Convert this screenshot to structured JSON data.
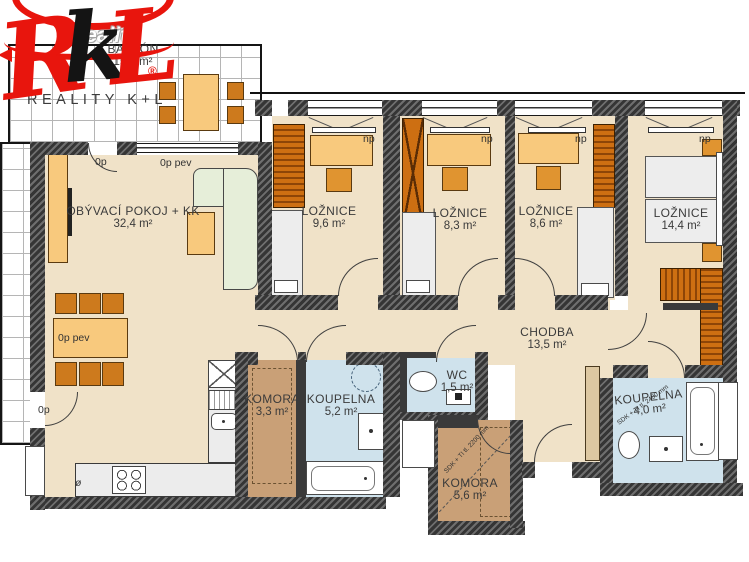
{
  "watermark": {
    "text": "Reality"
  },
  "logo": {
    "letter_r": "R",
    "letter_k": "k",
    "letter_l": "L",
    "registered": "®",
    "company": "REALITY K+L"
  },
  "rooms": {
    "balkon": {
      "name": "BALKÓN",
      "area": "15,5 m²"
    },
    "obyvaci": {
      "name": "OBÝVACÍ POKOJ + KK",
      "area": "32,4 m²"
    },
    "loznice1": {
      "name": "LOŽNICE",
      "area": "9,6 m²"
    },
    "loznice2": {
      "name": "LOŽNICE",
      "area": "8,3 m²"
    },
    "loznice3": {
      "name": "LOŽNICE",
      "area": "8,6 m²"
    },
    "loznice4": {
      "name": "LOŽNICE",
      "area": "14,4 m²"
    },
    "chodba": {
      "name": "CHODBA",
      "area": "13,5 m²"
    },
    "komora1": {
      "name": "KOMORA",
      "area": "3,3 m²"
    },
    "koupelna1": {
      "name": "KOUPELNA",
      "area": "5,2 m²"
    },
    "wc": {
      "name": "WC",
      "area": "1,5 m²"
    },
    "koupelna2": {
      "name": "KOUPELNA",
      "area": "4,0 m²"
    },
    "komora2": {
      "name": "KOMORA",
      "area": "5,6 m²"
    }
  },
  "annotations": {
    "door_top": "0p",
    "window_fixed": "0p pev",
    "table": "0p pev",
    "door_bottom": "0p",
    "np": "np",
    "diameter": "ø",
    "partition_note_1": "SDK + TI tl. 2200 mm",
    "partition_note_2": "SDK + TI tl. 2400 mm"
  },
  "colors": {
    "brand_red": "#e8150d",
    "wall": "#353535",
    "floor_main": "#f0e2c8",
    "floor_bath": "#cfe2ec",
    "floor_storage": "#c9a077",
    "furniture_orange": "#e09430",
    "sofa_green": "#e6eed9"
  }
}
